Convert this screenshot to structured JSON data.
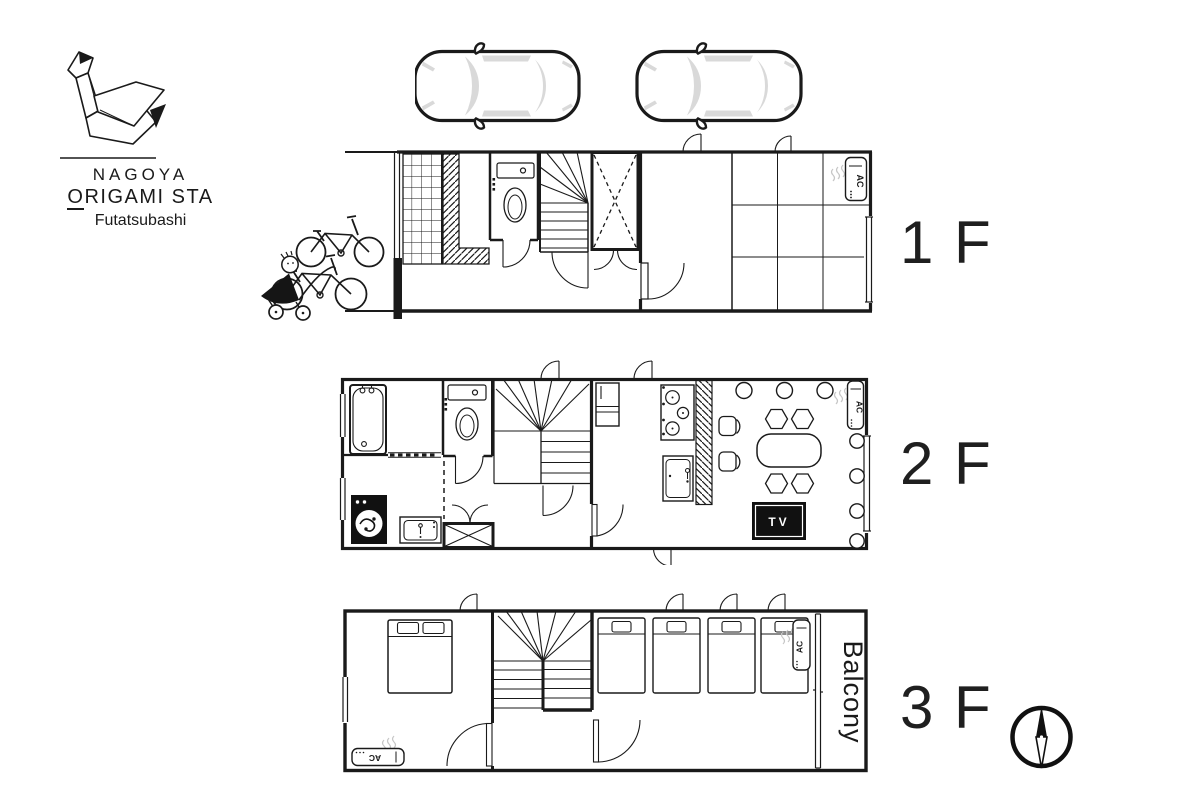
{
  "logo": {
    "name": "NAGOYA",
    "sub_o": "O",
    "sub_rest": "RIGAMI STA",
    "location": "Futatsubashi"
  },
  "floors": [
    {
      "id": "1f",
      "label": "1 F",
      "fixtures": [
        "tiled-entry",
        "sloped-hatch-wall",
        "toilet",
        "staircase",
        "closet",
        "tatami-room-3x3",
        "air-conditioner",
        "window"
      ]
    },
    {
      "id": "2f",
      "label": "2 F",
      "fixtures": [
        "bathtub",
        "washing-machine",
        "vanity-sink",
        "toilet",
        "shower-cubicle",
        "staircase",
        "refrigerator",
        "stove",
        "kitchen-sink",
        "hatched-counter",
        "dining-table",
        "hexagon-stools",
        "chairs",
        "tv",
        "air-conditioner",
        "windows"
      ]
    },
    {
      "id": "3f",
      "label": "3 F",
      "fixtures": [
        "double-bed",
        "single-bed",
        "single-bed",
        "single-bed",
        "single-bed",
        "staircase",
        "air-conditioner",
        "air-conditioner",
        "balcony",
        "window"
      ]
    }
  ],
  "labels": {
    "ac": "AC",
    "tv": "TV",
    "balcony": "Balcony"
  },
  "exterior": {
    "cars": 2,
    "bicycles": 2,
    "strollers": 1
  },
  "colors": {
    "line": "#1a1a1a",
    "fill_gray": "#d9d9d9",
    "steam_gray": "#c6c6c6",
    "black_fill": "#111111"
  },
  "icons": {
    "logo": "origami-swan-icon",
    "parking": "car-top-view-icon",
    "bicycle": "bicycle-icon",
    "stroller": "baby-stroller-icon",
    "compass": "compass-north-needle-icon"
  }
}
